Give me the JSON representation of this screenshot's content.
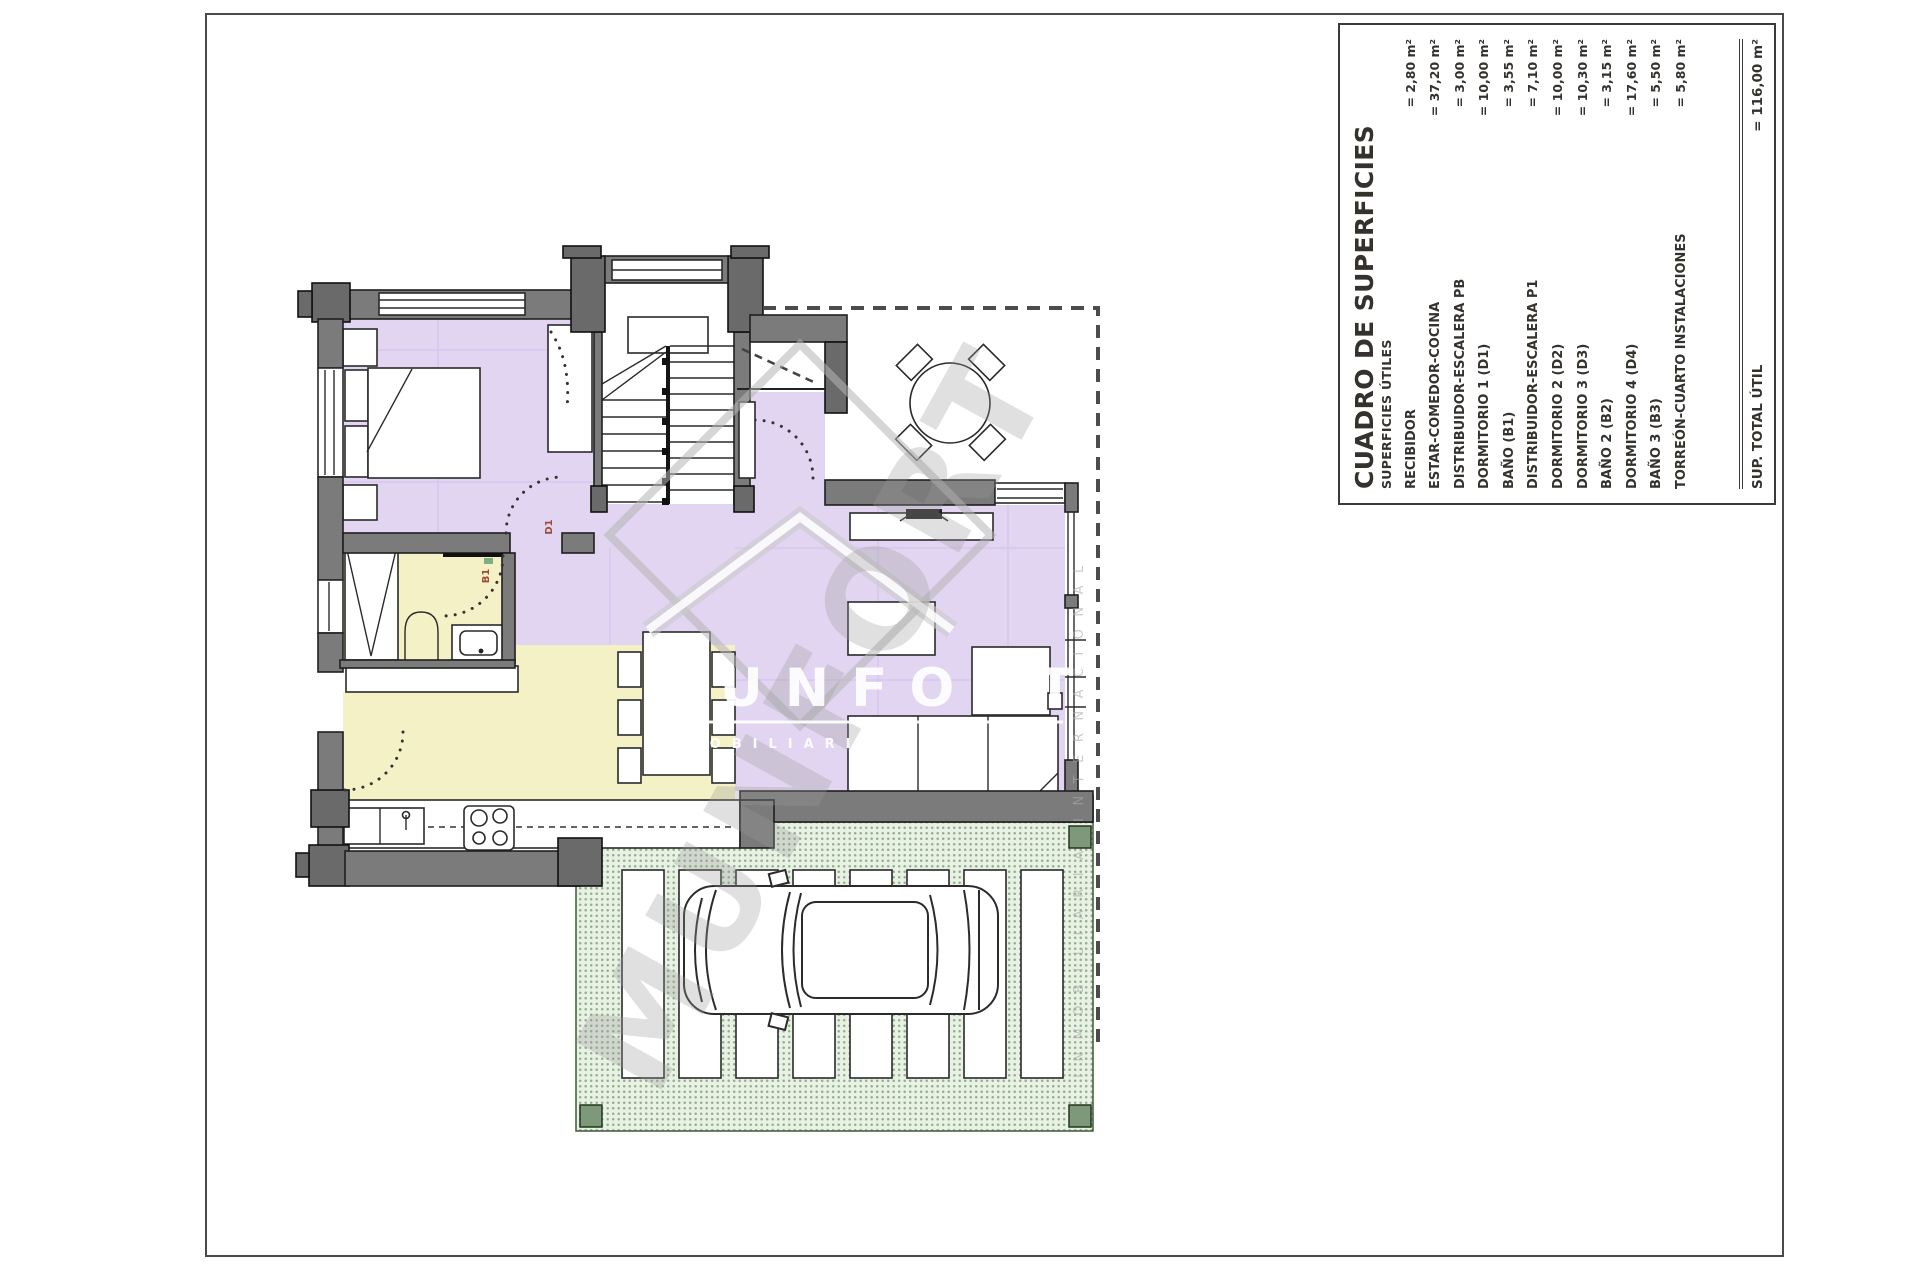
{
  "colors": {
    "purple": "#e2d5f2",
    "yellow": "#f5f1c6",
    "green_fill": "#cfe0ca",
    "wall": "#7b7b7b",
    "wall_dark": "#6a6a6a",
    "grid": "#d6c4ee",
    "label": "#9c4a3c"
  },
  "table": {
    "title": "CUADRO DE SUPERFICIES",
    "subtitle": "SUPERFICIES ÚTILES",
    "rows": [
      {
        "label": "RECIBIDOR",
        "value": "= 2,80 m²"
      },
      {
        "label": "ESTAR-COMEDOR-COCINA",
        "value": "= 37,20 m²"
      },
      {
        "label": "DISTRIBUIDOR-ESCALERA PB",
        "value": "= 3,00 m²"
      },
      {
        "label": "DORMITORIO 1 (D1)",
        "value": "= 10,00 m²"
      },
      {
        "label": "BAÑO (B1)",
        "value": "= 3,55 m²"
      },
      {
        "label": "DISTRIBUIDOR-ESCALERA P1",
        "value": "= 7,10 m²"
      },
      {
        "label": "DORMITORIO 2 (D2)",
        "value": "= 10,00 m²"
      },
      {
        "label": "DORMITORIO 3 (D3)",
        "value": "= 10,30 m²"
      },
      {
        "label": "BAÑO 2 (B2)",
        "value": "= 3,15 m²"
      },
      {
        "label": "DORMITORIO 4 (D4)",
        "value": "= 17,60 m²"
      },
      {
        "label": "BAÑO 3 (B3)",
        "value": "= 5,50 m²"
      },
      {
        "label": "TORREÓN-CUARTO INSTALACIONES",
        "value": "= 5,80 m²"
      }
    ],
    "total": {
      "label": "SUP. TOTAL ÚTIL",
      "value": "= 116,00 m²"
    }
  },
  "plan": {
    "room_labels": {
      "d1": "D1",
      "b1": "B1"
    }
  },
  "watermark": {
    "brand": "MUNFORT",
    "tagline": "INMOBILIARIA",
    "side_text": "INMOBILIARIA INTERNACIONAL"
  }
}
